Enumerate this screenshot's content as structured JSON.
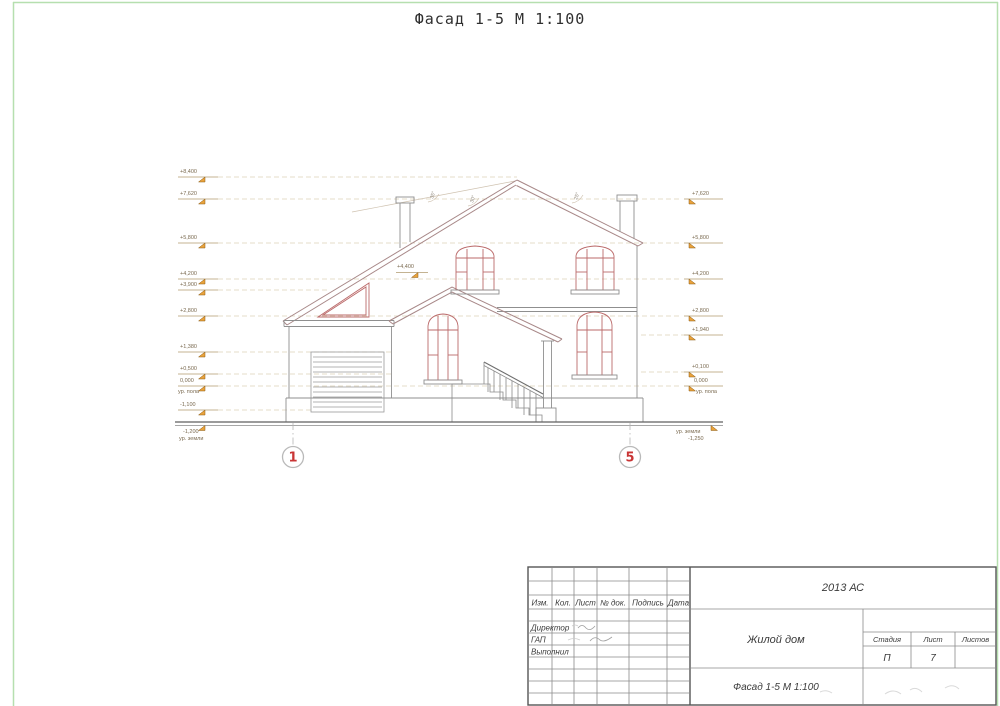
{
  "page_title": "Фасад 1-5 М 1:100",
  "colors": {
    "frame_green": "#b6dfaf",
    "axis_red": "#c93535",
    "elevation_flag_orange": "#eaa33c",
    "drawing_red": "#bb6a6a",
    "line_gray": "#8f8f8f"
  },
  "drawing": {
    "axes": [
      {
        "label": "1"
      },
      {
        "label": "5"
      }
    ],
    "roof_angles": [
      "35°",
      "30°",
      "25°"
    ],
    "marks_left": [
      {
        "value": "+8,400"
      },
      {
        "value": "+7,620"
      },
      {
        "value": "+5,800"
      },
      {
        "value": "+4,200"
      },
      {
        "value": "+3,900"
      },
      {
        "value": "+2,800"
      },
      {
        "value": "+1,380"
      },
      {
        "value": "+0,500"
      },
      {
        "value": "0,000",
        "note": "ур. пола"
      },
      {
        "value": "-1,100"
      },
      {
        "value": "-1,200",
        "note": "ур. земли"
      }
    ],
    "marks_right": [
      {
        "value": "+7,620"
      },
      {
        "value": "+5,800"
      },
      {
        "value": "+4,200"
      },
      {
        "value": "+2,800"
      },
      {
        "value": "+1,940"
      },
      {
        "value": "+0,100"
      },
      {
        "value": "0,000",
        "note": "ур. пола"
      },
      {
        "value": "-1,250",
        "note": "ур. земли"
      }
    ],
    "interior_mark": "+4,400"
  },
  "title_block": {
    "doc_code": "2013 АС",
    "object_name": "Жилой дом",
    "sheet_name": "Фасад 1-5 М 1:100",
    "header_cols": {
      "izm": "Изм.",
      "kol": "Кол.",
      "list": "Лист",
      "doc": "№ док.",
      "podpis": "Подпись",
      "data": "Дата"
    },
    "roles": {
      "r1": "Директор",
      "r2": "ГАП",
      "r3": "Выполнил"
    },
    "stage": {
      "label": "Стадия",
      "value": "П"
    },
    "sheet": {
      "label": "Лист",
      "value": "7"
    },
    "sheets": {
      "label": "Листов",
      "value": ""
    }
  }
}
